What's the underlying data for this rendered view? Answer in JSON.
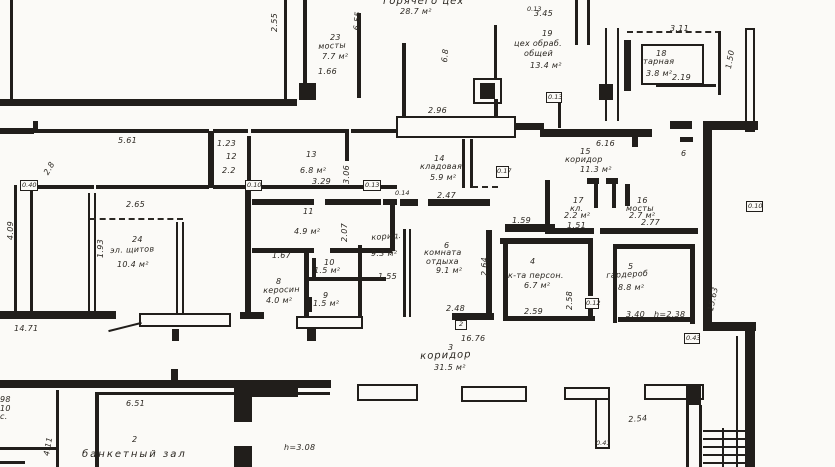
{
  "plan": {
    "title_room": {
      "name": "горячего цех",
      "area": "28.7 м²"
    },
    "rooms": {
      "r23": {
        "num": "23",
        "name": "мосты",
        "area": "7.7 м²",
        "dim": "1.66"
      },
      "r19": {
        "num": "19",
        "name1": "цех обраб.",
        "name2": "общей",
        "area": "13.4 м²",
        "dim": "3.45"
      },
      "r18": {
        "num": "18",
        "name": "тарная",
        "area": "3.8 м²",
        "dim": "2.19",
        "dim2": "3.11"
      },
      "r12": {
        "num": "12",
        "dim": "2.2",
        "dim2": "1.23"
      },
      "r13": {
        "num": "13",
        "area": "6.8 м²",
        "dim": "3.29"
      },
      "r11": {
        "num": "11",
        "area": "4.9 м²"
      },
      "r24": {
        "num": "24",
        "name": "эл. щитов",
        "area": "10.4 м²",
        "dim": "2.65"
      },
      "r14": {
        "num": "14",
        "name": "кладовая",
        "area": "5.9 м²",
        "dim": "2.47"
      },
      "r7": {
        "name": "корид.",
        "area": "9.3 м²",
        "dim": "1.55"
      },
      "r6": {
        "num": "6",
        "name1": "комната",
        "name2": "отдыха",
        "area": "9.1 м²",
        "dim": "2.48"
      },
      "r8": {
        "num": "8",
        "name": "керосин",
        "area": "4.0 м²",
        "dim": "1.67"
      },
      "r9": {
        "num": "9",
        "area": "1.5 м²"
      },
      "r10": {
        "num": "10",
        "area": "1.5 м²"
      },
      "r15": {
        "num": "15",
        "name": "коридор",
        "area": "11.3 м²",
        "dim": "6.16"
      },
      "r17": {
        "num": "17",
        "name": "кл.",
        "area": "2.2 м²",
        "dim": "1.51"
      },
      "r16": {
        "num": "16",
        "name": "мосты",
        "area": "2.7 м²",
        "dim": "2.77"
      },
      "r4": {
        "num": "4",
        "name": "к-та персон.",
        "area": "6.7 м²",
        "dim": "2.59"
      },
      "r5": {
        "num": "5",
        "name": "гардероб",
        "area": "8.8 м²",
        "dim": "3.40",
        "height": "h=2.38"
      },
      "r3": {
        "num": "3",
        "name": "коридор",
        "area": "31.5 м²",
        "dim": "16.76"
      },
      "r2": {
        "num": "2",
        "name": "банкетный зал",
        "dim": "6.51",
        "height": "h=3.08"
      }
    },
    "dims": {
      "v255": "2.55",
      "v655": "6.55",
      "t013a": "0.13",
      "d296": "2.96",
      "d561": "5.61",
      "t040": "0.40",
      "t010a": "0.10",
      "t010b": "0.10",
      "v193": "1.93",
      "v306": "3.06",
      "v207": "2.07",
      "t013b": "0.13",
      "t014": "0.14",
      "t017": "0.17",
      "t013c": "0.13",
      "d159": "1.59",
      "d1471": "14.71",
      "v264": "2.64",
      "v258": "2.58",
      "t012": "0.12",
      "v1563": "15.63",
      "t043": "0.43",
      "d254": "2.54",
      "t041": "0.41",
      "v411": "4.11",
      "v409": "4.09",
      "v28": "2.8",
      "axis6": "6",
      "v68": "6.8",
      "v150": "1.50",
      "tag2": "2"
    },
    "fragments": {
      "f98": "98",
      "f10": "10",
      "fs": "с."
    }
  }
}
